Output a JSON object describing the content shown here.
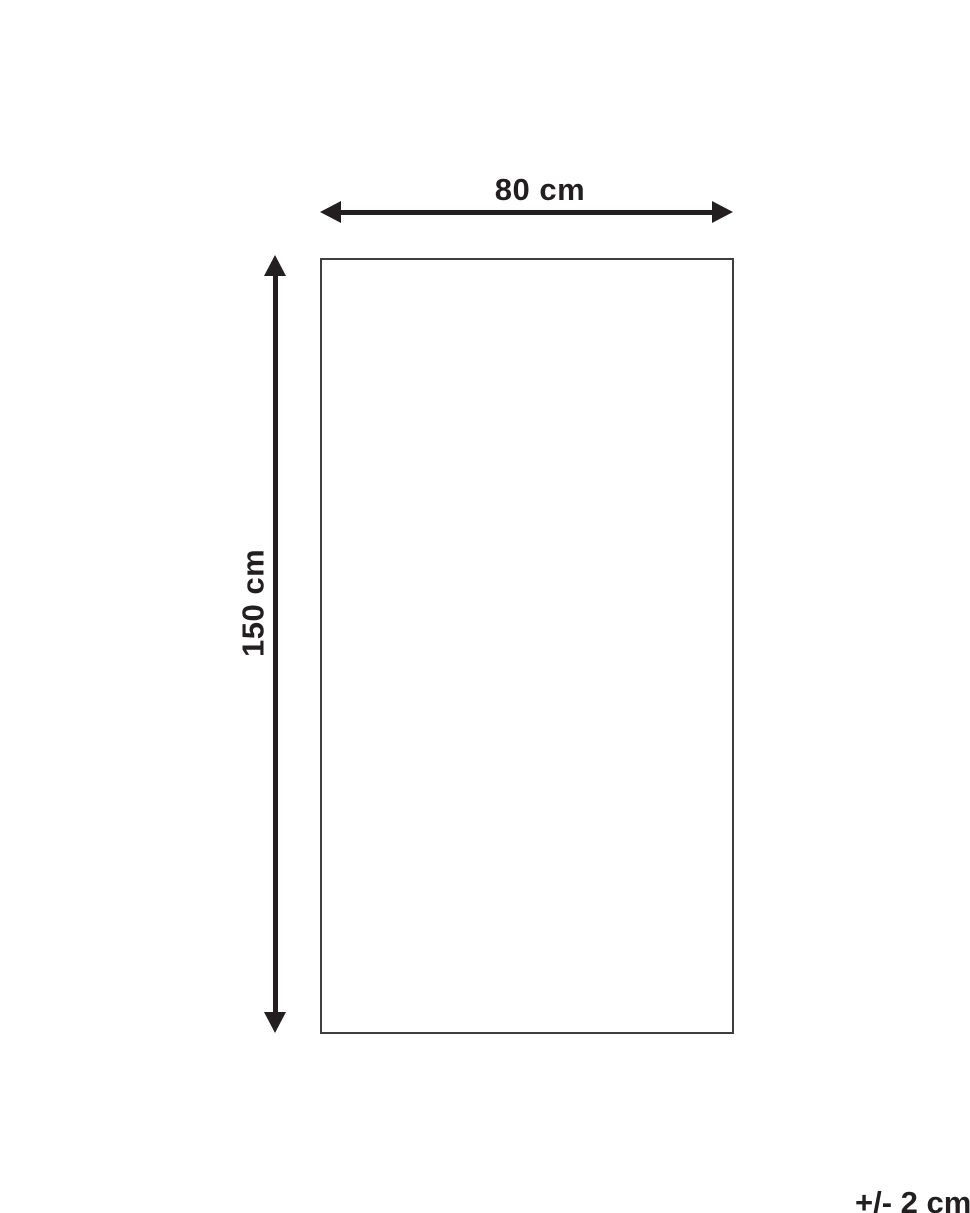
{
  "diagram": {
    "type": "product-dimension-drawing",
    "shape": "rectangle",
    "width_label": "80 cm",
    "height_label": "150 cm",
    "tolerance_label": "+/- 2 cm",
    "dimensions": {
      "width_cm": 80,
      "height_cm": 150,
      "tolerance_cm": 2
    },
    "colors": {
      "background": "#ffffff",
      "arrow_and_text": "#231f20",
      "rectangle_border": "#3f3f3f"
    }
  }
}
